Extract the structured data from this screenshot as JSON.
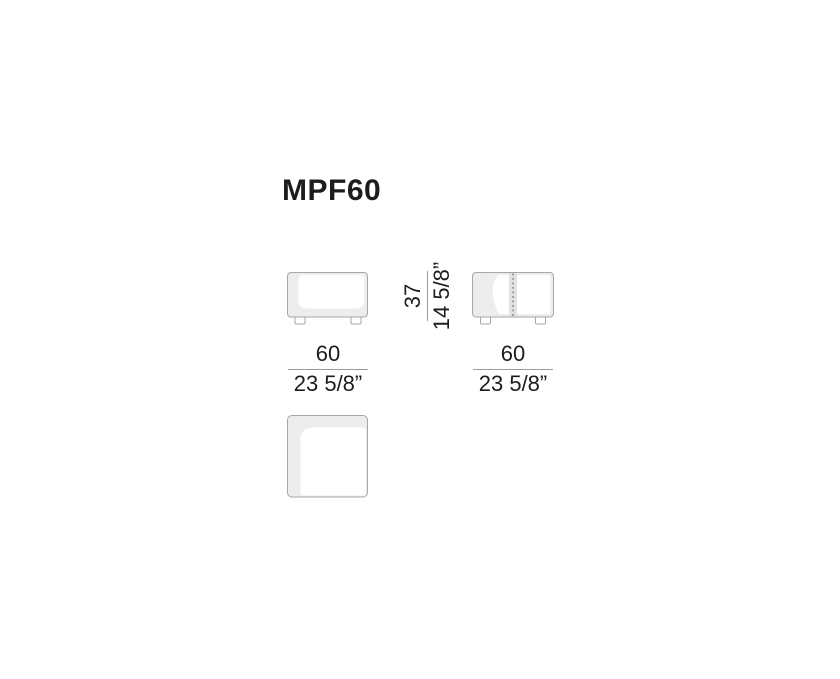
{
  "title": "MPF60",
  "dims": {
    "front_width": {
      "cm": "60",
      "in": "23 5/8”"
    },
    "side_width": {
      "cm": "60",
      "in": "23 5/8”"
    },
    "height": {
      "cm": "37",
      "in": "14 5/8”"
    }
  },
  "views": {
    "front": "front-view-drawing",
    "side": "side-view-drawing-with-stitch-line",
    "top": "top-view-drawing"
  },
  "colors": {
    "text": "#1d1d1b",
    "stroke": "#a7a7a7",
    "shade": "#ededed",
    "stripe": "#e2e2e2",
    "dots": "#8f8f8f",
    "dimline": "#9b9b9b",
    "bg": "#ffffff"
  }
}
